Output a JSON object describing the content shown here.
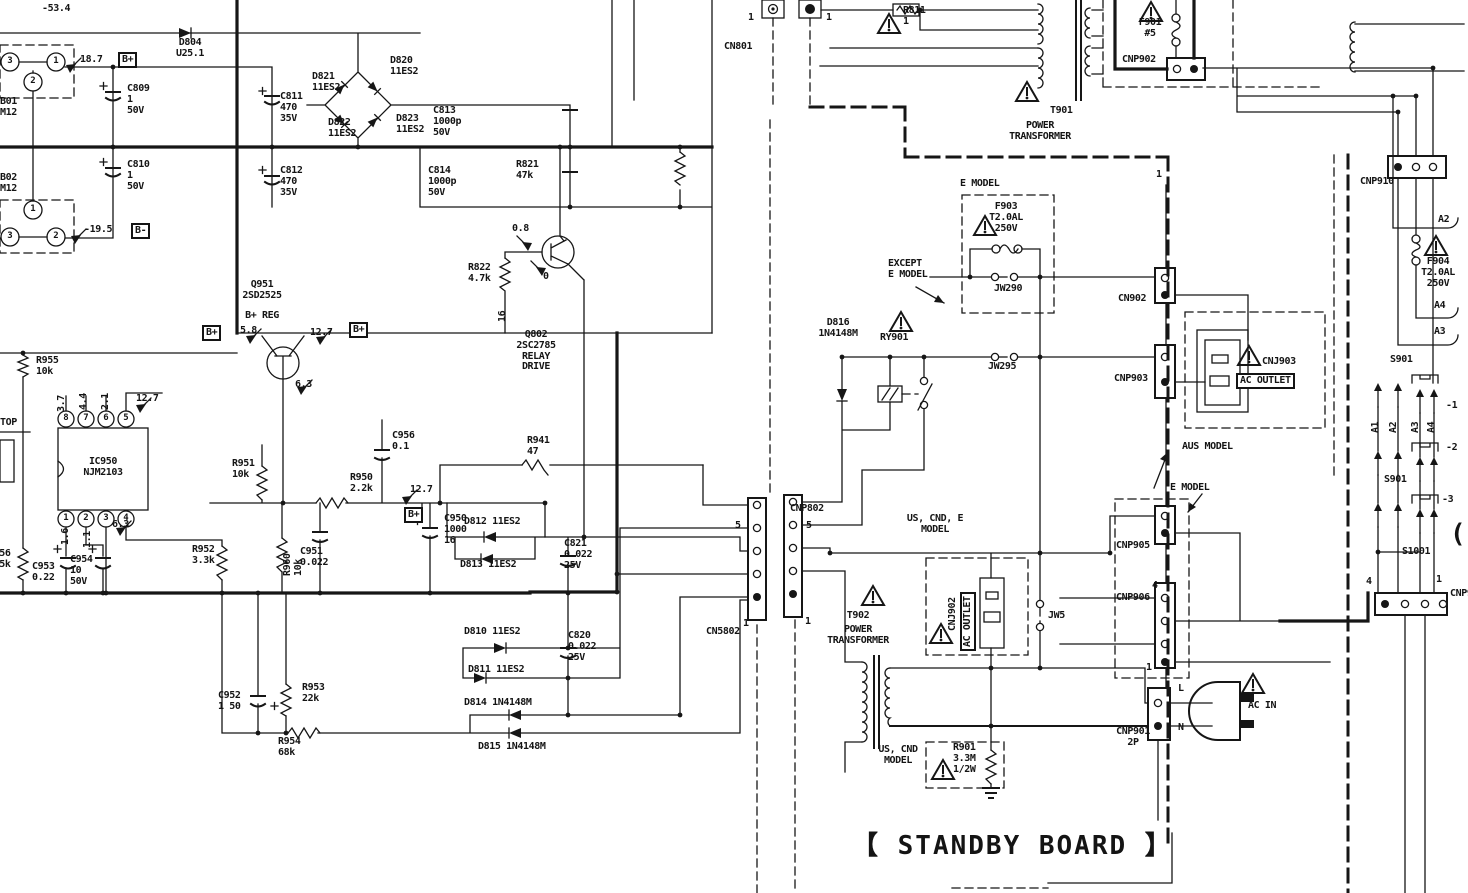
{
  "meta": {
    "title": "Power supply / standby board schematic",
    "board": "STANDBY BOARD"
  },
  "colors": {
    "ink": "#161616",
    "paper": "#ffffff"
  },
  "labels": [
    {
      "name": "voltage--53-4",
      "text": "-53.4",
      "x": 42,
      "y": 4,
      "cls": ""
    },
    {
      "name": "diode-d804",
      "text": "D804\nU25.1",
      "x": 190,
      "y": 38,
      "cls": "ctr"
    },
    {
      "name": "voltage-18-7",
      "text": "18.7",
      "x": 80,
      "y": 55,
      "cls": ""
    },
    {
      "name": "bplus-badge-top",
      "text": "B+",
      "x": 118,
      "y": 52,
      "cls": "bx"
    },
    {
      "name": "cap-c809",
      "text": "C809\n1\n50V",
      "x": 127,
      "y": 84,
      "cls": ""
    },
    {
      "name": "jack-b01",
      "text": "B01\nM12",
      "x": 0,
      "y": 97,
      "cls": ""
    },
    {
      "name": "jack-b02",
      "text": "B02\nM12",
      "x": 0,
      "y": 173,
      "cls": ""
    },
    {
      "name": "cap-c810",
      "text": "C810\n1\n50V",
      "x": 127,
      "y": 160,
      "cls": ""
    },
    {
      "name": "voltage--19-5",
      "text": "-19.5",
      "x": 84,
      "y": 225,
      "cls": ""
    },
    {
      "name": "bminus-badge",
      "text": "B-",
      "x": 131,
      "y": 223,
      "cls": "bx"
    },
    {
      "name": "diode-d821",
      "text": "D821\n11ES2",
      "x": 312,
      "y": 72,
      "cls": ""
    },
    {
      "name": "diode-d820",
      "text": "D820\n11ES2",
      "x": 390,
      "y": 56,
      "cls": ""
    },
    {
      "name": "diode-d822",
      "text": "D822\n11ES2",
      "x": 328,
      "y": 118,
      "cls": ""
    },
    {
      "name": "diode-d823",
      "text": "D823\n11ES2",
      "x": 396,
      "y": 114,
      "cls": ""
    },
    {
      "name": "cap-c811",
      "text": "C811\n470\n35V",
      "x": 280,
      "y": 92,
      "cls": ""
    },
    {
      "name": "cap-c813",
      "text": "C813\n1000p\n50V",
      "x": 433,
      "y": 106,
      "cls": ""
    },
    {
      "name": "cap-c812",
      "text": "C812\n470\n35V",
      "x": 280,
      "y": 166,
      "cls": ""
    },
    {
      "name": "cap-c814",
      "text": "C814\n1000p\n50V",
      "x": 428,
      "y": 166,
      "cls": ""
    },
    {
      "name": "res-r821",
      "text": "R821\n47k",
      "x": 516,
      "y": 160,
      "cls": ""
    },
    {
      "name": "voltage-0-8",
      "text": "0.8",
      "x": 512,
      "y": 224,
      "cls": ""
    },
    {
      "name": "res-r822",
      "text": "R822\n4.7k",
      "x": 468,
      "y": 263,
      "cls": ""
    },
    {
      "name": "voltage-0",
      "text": "0",
      "x": 543,
      "y": 272,
      "cls": ""
    },
    {
      "name": "voltage-16",
      "text": "16",
      "x": 498,
      "y": 322,
      "cls": "rot"
    },
    {
      "name": "trans-q951",
      "text": "Q951\n2SD2525",
      "x": 262,
      "y": 280,
      "cls": "ctr"
    },
    {
      "name": "trans-q951-fn",
      "text": "B+ REG",
      "x": 262,
      "y": 311,
      "cls": "ctr"
    },
    {
      "name": "bplus-badge-a",
      "text": "B+",
      "x": 202,
      "y": 325,
      "cls": "bx"
    },
    {
      "name": "voltage-5-8",
      "text": "5.8",
      "x": 240,
      "y": 326,
      "cls": ""
    },
    {
      "name": "voltage-12-7a",
      "text": "12.7",
      "x": 310,
      "y": 328,
      "cls": ""
    },
    {
      "name": "bplus-badge-b",
      "text": "B+",
      "x": 349,
      "y": 322,
      "cls": "bx"
    },
    {
      "name": "voltage-6-3a",
      "text": "6.3",
      "x": 295,
      "y": 380,
      "cls": ""
    },
    {
      "name": "trans-q802",
      "text": "Q802\n2SC2785\nRELAY\nDRIVE",
      "x": 536,
      "y": 330,
      "cls": "ctr"
    },
    {
      "name": "res-r955",
      "text": "R955\n10k",
      "x": 36,
      "y": 356,
      "cls": ""
    },
    {
      "name": "label-top",
      "text": "TOP",
      "x": 0,
      "y": 418,
      "cls": ""
    },
    {
      "name": "ic-ic950",
      "text": "IC950\nNJM2103",
      "x": 103,
      "y": 457,
      "cls": "ctr"
    },
    {
      "name": "ic-pin-8",
      "text": "8",
      "x": 66,
      "y": 419,
      "cls": "pin"
    },
    {
      "name": "ic-pin-7",
      "text": "7",
      "x": 86,
      "y": 419,
      "cls": "pin"
    },
    {
      "name": "ic-pin-6",
      "text": "6",
      "x": 106,
      "y": 419,
      "cls": "pin"
    },
    {
      "name": "ic-pin-5",
      "text": "5",
      "x": 126,
      "y": 419,
      "cls": "pin"
    },
    {
      "name": "ic-pin-1",
      "text": "1",
      "x": 66,
      "y": 519,
      "cls": "pin"
    },
    {
      "name": "ic-pin-2",
      "text": "2",
      "x": 86,
      "y": 519,
      "cls": "pin"
    },
    {
      "name": "ic-pin-3",
      "text": "3",
      "x": 106,
      "y": 519,
      "cls": "pin"
    },
    {
      "name": "ic-pin-4",
      "text": "4",
      "x": 126,
      "y": 519,
      "cls": "pin"
    },
    {
      "name": "voltage-3-7",
      "text": "3.7",
      "x": 57,
      "y": 412,
      "cls": "rot"
    },
    {
      "name": "voltage-4-4",
      "text": "4.4",
      "x": 79,
      "y": 410,
      "cls": "rot"
    },
    {
      "name": "voltage-2-1",
      "text": "2.1",
      "x": 101,
      "y": 410,
      "cls": "rot"
    },
    {
      "name": "voltage-12-7c",
      "text": "12.7",
      "x": 136,
      "y": 394,
      "cls": ""
    },
    {
      "name": "voltage-1-6",
      "text": "1.6",
      "x": 61,
      "y": 545,
      "cls": "rot"
    },
    {
      "name": "voltage-1-1",
      "text": "1.1",
      "x": 83,
      "y": 548,
      "cls": "rot"
    },
    {
      "name": "voltage-6-3b",
      "text": "6.3",
      "x": 112,
      "y": 520,
      "cls": ""
    },
    {
      "name": "res-r956",
      "text": "R956\n5.5k",
      "x": -12,
      "y": 549,
      "cls": ""
    },
    {
      "name": "cap-c953",
      "text": "C953\n0.22",
      "x": 32,
      "y": 562,
      "cls": ""
    },
    {
      "name": "cap-c954",
      "text": "C954\n10\n50V",
      "x": 70,
      "y": 555,
      "cls": ""
    },
    {
      "name": "res-r952",
      "text": "R952\n3.3k",
      "x": 192,
      "y": 545,
      "cls": ""
    },
    {
      "name": "res-r951",
      "text": "R951\n10k",
      "x": 232,
      "y": 459,
      "cls": ""
    },
    {
      "name": "res-r960",
      "text": "R960\n10k",
      "x": 283,
      "y": 576,
      "cls": "rot"
    },
    {
      "name": "cap-c951",
      "text": "C951\n0.022",
      "x": 300,
      "y": 547,
      "cls": ""
    },
    {
      "name": "res-r950",
      "text": "R950\n2.2k",
      "x": 350,
      "y": 473,
      "cls": ""
    },
    {
      "name": "cap-c950",
      "text": "C950\n1000\n16",
      "x": 444,
      "y": 514,
      "cls": ""
    },
    {
      "name": "cap-c956",
      "text": "C956\n0.1",
      "x": 392,
      "y": 431,
      "cls": ""
    },
    {
      "name": "voltage-12-7b",
      "text": "12.7",
      "x": 410,
      "y": 485,
      "cls": ""
    },
    {
      "name": "bplus-badge-c",
      "text": "B+",
      "x": 404,
      "y": 507,
      "cls": "bx"
    },
    {
      "name": "cap-c952",
      "text": "C952\n1 50",
      "x": 218,
      "y": 691,
      "cls": ""
    },
    {
      "name": "res-r953",
      "text": "R953\n22k",
      "x": 302,
      "y": 683,
      "cls": ""
    },
    {
      "name": "res-r954",
      "text": "R954\n68k",
      "x": 278,
      "y": 737,
      "cls": ""
    },
    {
      "name": "diode-d812",
      "text": "D812 11ES2",
      "x": 464,
      "y": 517,
      "cls": ""
    },
    {
      "name": "diode-d813",
      "text": "D813 11ES2",
      "x": 460,
      "y": 560,
      "cls": ""
    },
    {
      "name": "diode-d810",
      "text": "D810 11ES2",
      "x": 464,
      "y": 627,
      "cls": ""
    },
    {
      "name": "diode-d811",
      "text": "D811 11ES2",
      "x": 468,
      "y": 665,
      "cls": ""
    },
    {
      "name": "cap-c821",
      "text": "C821\n0.022\n25V",
      "x": 564,
      "y": 539,
      "cls": ""
    },
    {
      "name": "cap-c820",
      "text": "C820\n0.022\n25V",
      "x": 568,
      "y": 631,
      "cls": ""
    },
    {
      "name": "res-r941",
      "text": "R941\n47",
      "x": 527,
      "y": 436,
      "cls": ""
    },
    {
      "name": "diode-d814",
      "text": "D814 1N4148M",
      "x": 464,
      "y": 698,
      "cls": ""
    },
    {
      "name": "diode-d815",
      "text": "D815 1N4148M",
      "x": 478,
      "y": 742,
      "cls": ""
    },
    {
      "name": "conn-cn801",
      "text": "CN801",
      "x": 724,
      "y": 42,
      "cls": ""
    },
    {
      "name": "pin1-cn801a",
      "text": "1",
      "x": 748,
      "y": 13,
      "cls": ""
    },
    {
      "name": "pin1-cn801b",
      "text": "1",
      "x": 826,
      "y": 13,
      "cls": ""
    },
    {
      "name": "res-r811",
      "text": "R811\n1",
      "x": 903,
      "y": 6,
      "cls": ""
    },
    {
      "name": "xfmr-t901",
      "text": "T901",
      "x": 1050,
      "y": 106,
      "cls": ""
    },
    {
      "name": "xfmr-t901-name",
      "text": "POWER\nTRANSFORMER",
      "x": 1040,
      "y": 121,
      "cls": "ctr"
    },
    {
      "name": "fuse-f901",
      "text": "F901\n#5",
      "x": 1150,
      "y": 18,
      "cls": "ctr"
    },
    {
      "name": "conn-cnp902",
      "text": "CNP902",
      "x": 1122,
      "y": 55,
      "cls": ""
    },
    {
      "name": "conn-cnp910",
      "text": "CNP910",
      "x": 1360,
      "y": 177,
      "cls": ""
    },
    {
      "name": "emodel-1",
      "text": "E MODEL",
      "x": 960,
      "y": 179,
      "cls": ""
    },
    {
      "name": "fuse-f903",
      "text": "F903\nT2.0AL\n250V",
      "x": 1006,
      "y": 202,
      "cls": "ctr"
    },
    {
      "name": "except-emodel",
      "text": "EXCEPT\nE MODEL",
      "x": 888,
      "y": 259,
      "cls": ""
    },
    {
      "name": "jumper-jw290",
      "text": "JW290",
      "x": 994,
      "y": 284,
      "cls": ""
    },
    {
      "name": "pin1-cn902",
      "text": "1",
      "x": 1156,
      "y": 170,
      "cls": ""
    },
    {
      "name": "conn-cn902",
      "text": "CN902",
      "x": 1118,
      "y": 294,
      "cls": ""
    },
    {
      "name": "diode-d816",
      "text": "D816\n1N4148M",
      "x": 838,
      "y": 318,
      "cls": "ctr"
    },
    {
      "name": "relay-ry901",
      "text": "RY901",
      "x": 880,
      "y": 333,
      "cls": ""
    },
    {
      "name": "jumper-jw295",
      "text": "JW295",
      "x": 988,
      "y": 362,
      "cls": ""
    },
    {
      "name": "conn-cnp903",
      "text": "CNP903",
      "x": 1114,
      "y": 374,
      "cls": ""
    },
    {
      "name": "conn-cnj903",
      "text": "CNJ903",
      "x": 1262,
      "y": 357,
      "cls": ""
    },
    {
      "name": "ac-outlet-aus",
      "text": "AC OUTLET",
      "x": 1236,
      "y": 373,
      "cls": "bx"
    },
    {
      "name": "aus-model",
      "text": "AUS MODEL",
      "x": 1182,
      "y": 442,
      "cls": ""
    },
    {
      "name": "wire-a2",
      "text": "A2",
      "x": 1438,
      "y": 215,
      "cls": ""
    },
    {
      "name": "fuse-f904",
      "text": "F904\nT2.0AL\n250V",
      "x": 1438,
      "y": 257,
      "cls": "ctr"
    },
    {
      "name": "wire-a4",
      "text": "A4",
      "x": 1434,
      "y": 301,
      "cls": ""
    },
    {
      "name": "wire-a3",
      "text": "A3",
      "x": 1434,
      "y": 327,
      "cls": ""
    },
    {
      "name": "switch-s901",
      "text": "S901",
      "x": 1390,
      "y": 355,
      "cls": ""
    },
    {
      "name": "wire-a1-rot",
      "text": "A1",
      "x": 1371,
      "y": 433,
      "cls": "rot"
    },
    {
      "name": "wire-a2-rot",
      "text": "A2",
      "x": 1389,
      "y": 433,
      "cls": "rot"
    },
    {
      "name": "wire-a3-rot",
      "text": "A3",
      "x": 1411,
      "y": 433,
      "cls": "rot"
    },
    {
      "name": "wire-a4-rot",
      "text": "A4",
      "x": 1427,
      "y": 433,
      "cls": "rot"
    },
    {
      "name": "sw-section-1",
      "text": "-1",
      "x": 1446,
      "y": 401,
      "cls": ""
    },
    {
      "name": "sw-section-2",
      "text": "-2",
      "x": 1446,
      "y": 443,
      "cls": ""
    },
    {
      "name": "switch-s901-b",
      "text": "S901",
      "x": 1384,
      "y": 475,
      "cls": ""
    },
    {
      "name": "sw-section-3",
      "text": "-3",
      "x": 1442,
      "y": 495,
      "cls": ""
    },
    {
      "name": "switch-s1001",
      "text": "S1001",
      "x": 1402,
      "y": 547,
      "cls": ""
    },
    {
      "name": "pin4-bottom-conn",
      "text": "4",
      "x": 1366,
      "y": 577,
      "cls": ""
    },
    {
      "name": "pin1-bottom-conn",
      "text": "1",
      "x": 1436,
      "y": 575,
      "cls": ""
    },
    {
      "name": "conn-cnp9-cut",
      "text": "CNP9",
      "x": 1450,
      "y": 589,
      "cls": ""
    },
    {
      "name": "right-edge-bracket",
      "text": "(",
      "x": 1450,
      "y": 520,
      "cls": "big"
    },
    {
      "name": "us-cnd-e-model",
      "text": "US, CND, E\nMODEL",
      "x": 935,
      "y": 514,
      "cls": "ctr"
    },
    {
      "name": "conn-cnj902",
      "text": "CNJ902",
      "x": 948,
      "y": 631,
      "cls": "rot"
    },
    {
      "name": "ac-outlet-us",
      "text": "AC OUTLET",
      "x": 960,
      "y": 651,
      "cls": "bx rot"
    },
    {
      "name": "xfmr-t902",
      "text": "T902",
      "x": 858,
      "y": 611,
      "cls": "ctr"
    },
    {
      "name": "xfmr-t902-name",
      "text": "POWER\nTRANSFORMER",
      "x": 858,
      "y": 625,
      "cls": "ctr"
    },
    {
      "name": "jumper-jw5",
      "text": "JW5",
      "x": 1048,
      "y": 611,
      "cls": ""
    },
    {
      "name": "conn-cnp905",
      "text": "CNP905",
      "x": 1116,
      "y": 541,
      "cls": ""
    },
    {
      "name": "emodel-2",
      "text": "E MODEL",
      "x": 1170,
      "y": 483,
      "cls": ""
    },
    {
      "name": "pin4-cnp906",
      "text": "4",
      "x": 1152,
      "y": 581,
      "cls": ""
    },
    {
      "name": "conn-cnp906",
      "text": "CNP906",
      "x": 1116,
      "y": 593,
      "cls": ""
    },
    {
      "name": "pin1-cnp906",
      "text": "1",
      "x": 1146,
      "y": 663,
      "cls": ""
    },
    {
      "name": "conn-cnp901",
      "text": "CNP901\n2P",
      "x": 1133,
      "y": 727,
      "cls": "ctr"
    },
    {
      "name": "line-l",
      "text": "L",
      "x": 1178,
      "y": 684,
      "cls": ""
    },
    {
      "name": "line-n",
      "text": "N",
      "x": 1178,
      "y": 723,
      "cls": ""
    },
    {
      "name": "ac-in",
      "text": "AC IN",
      "x": 1248,
      "y": 701,
      "cls": ""
    },
    {
      "name": "us-cnd-model",
      "text": "US, CND\nMODEL",
      "x": 898,
      "y": 745,
      "cls": "ctr"
    },
    {
      "name": "res-r901",
      "text": "R901\n3.3M\n1/2W",
      "x": 953,
      "y": 743,
      "cls": ""
    },
    {
      "name": "standby-board-title",
      "text": "【 STANDBY BOARD 】",
      "x": 852,
      "y": 832,
      "cls": "big"
    },
    {
      "name": "conn-cn5802",
      "text": "CN5802",
      "x": 706,
      "y": 627,
      "cls": ""
    },
    {
      "name": "pin5-cn5802",
      "text": "5",
      "x": 735,
      "y": 521,
      "cls": ""
    },
    {
      "name": "pin1-cn5802",
      "text": "1",
      "x": 743,
      "y": 619,
      "cls": ""
    },
    {
      "name": "conn-cnp802",
      "text": "CNP802",
      "x": 790,
      "y": 504,
      "cls": ""
    },
    {
      "name": "pin5-cnp802",
      "text": "5",
      "x": 806,
      "y": 521,
      "cls": ""
    },
    {
      "name": "pin1-cnp802",
      "text": "1",
      "x": 805,
      "y": 617,
      "cls": ""
    },
    {
      "name": "jack1-pin-3",
      "text": "3",
      "x": 10,
      "y": 62,
      "cls": "pin"
    },
    {
      "name": "jack1-pin-1",
      "text": "1",
      "x": 56,
      "y": 62,
      "cls": "pin"
    },
    {
      "name": "jack1-pin-2",
      "text": "2",
      "x": 33,
      "y": 82,
      "cls": "pin"
    },
    {
      "name": "jack2-pin-1",
      "text": "1",
      "x": 33,
      "y": 210,
      "cls": "pin"
    },
    {
      "name": "jack2-pin-3",
      "text": "3",
      "x": 10,
      "y": 237,
      "cls": "pin"
    },
    {
      "name": "jack2-pin-2",
      "text": "2",
      "x": 56,
      "y": 237,
      "cls": "pin"
    }
  ]
}
